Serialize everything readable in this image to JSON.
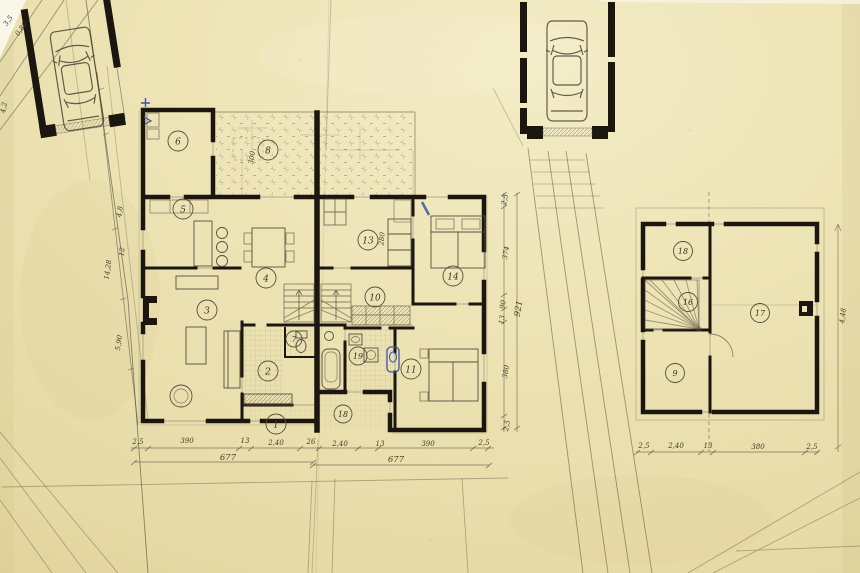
{
  "ground_floor": {
    "room_labels": {
      "r1": "1",
      "r2": "2",
      "r3": "3",
      "r4": "4",
      "r5": "5",
      "r6": "6",
      "r7": "7",
      "r8": "8",
      "r10": "10",
      "r11": "11",
      "r13": "13",
      "r14": "14",
      "r18": "18",
      "r19": "19"
    },
    "dims_bottom": [
      "2,5",
      "390",
      "13",
      "2,40",
      "26",
      "2,40",
      "13",
      "390",
      "2,5"
    ],
    "totals_bottom": [
      "677",
      "677"
    ],
    "dims_right": [
      "2,5",
      "374",
      "90",
      "13",
      "380",
      "2,5"
    ],
    "total_right": "921",
    "dims_left": [
      "4,8",
      "12",
      "14,28",
      "5,90"
    ],
    "wall_annotations": [
      "300",
      "280"
    ]
  },
  "upper_floor": {
    "room_labels": {
      "r9": "9",
      "r16": "16",
      "r17": "17",
      "r18": "18"
    },
    "dims_bottom": [
      "2,5",
      "2,40",
      "13",
      "380",
      "2,5"
    ],
    "dim_right": "4,48"
  },
  "site": {
    "dims_top_left": [
      "3,5",
      "0,80"
    ],
    "dim_left_edge": "4,2"
  },
  "colors": {
    "paper": "#ebe1b2",
    "ink": "#1b160f",
    "pencil": "#55503f",
    "blue_ink": "#3a56a8"
  }
}
